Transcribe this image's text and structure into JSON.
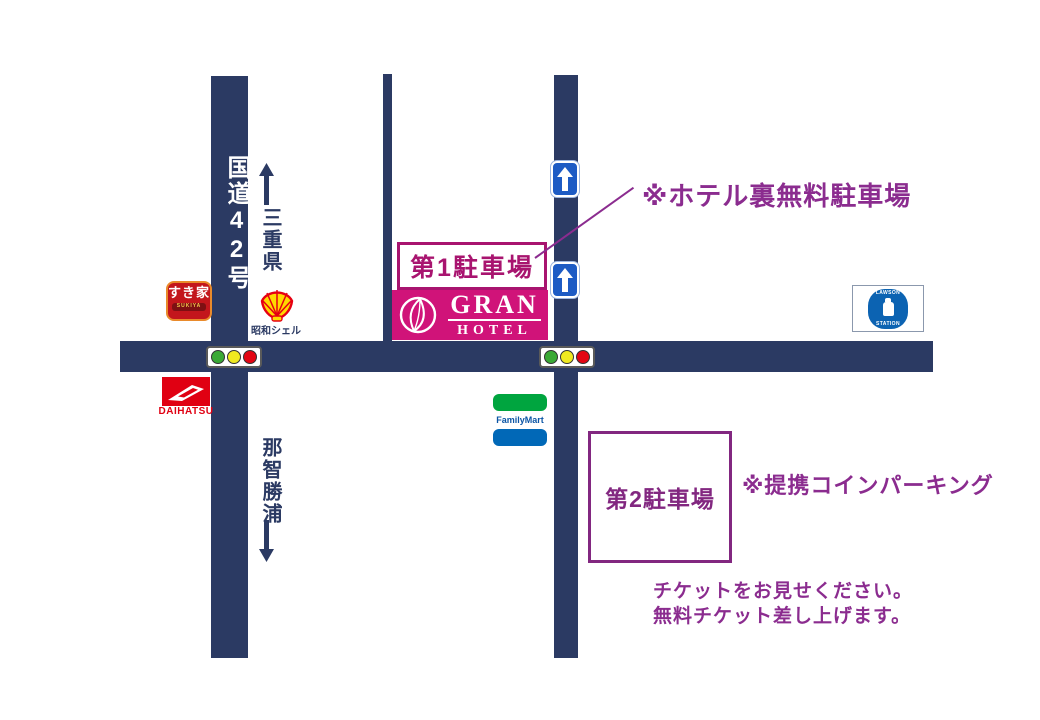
{
  "roads": {
    "route_label": "国道42号",
    "north_label": "三重県",
    "south_label": "那智勝浦"
  },
  "parking1": {
    "label": "第1駐車場",
    "note": "※ホテル裏無料駐車場"
  },
  "parking2": {
    "label": "第2駐車場",
    "note": "※提携コインパーキング",
    "ticket_line1": "チケットをお見せください。",
    "ticket_line2": "無料チケット差し上げます。"
  },
  "landmarks": {
    "sukiya": {
      "name": "すき家",
      "sub": "SUKIYA"
    },
    "shell": {
      "caption": "昭和シェル"
    },
    "daihatsu": {
      "caption": "DAIHATSU"
    },
    "gran_hotel": {
      "line1": "GRAN",
      "line2": "HOTEL"
    },
    "lawson": {
      "line1": "LAWSON",
      "line2": "STATION"
    },
    "familymart": {
      "name": "FamilyMart"
    }
  },
  "icons": {
    "north-arrow-icon": "navy up arrow",
    "south-arrow-icon": "navy down arrow",
    "one-way-up-sign-icon": "blue square sign with white up arrow (x2)",
    "traffic-light-icon": "green/yellow/red lamps (x2)",
    "shell-icon": "yellow pecten shell with red ribs",
    "daihatsu-d-icon": "white stylized D swoosh on red",
    "gran-leaf-icon": "white leaf in white circle outline",
    "milk-bottle-icon": "white milk bottle in Lawson emblem"
  },
  "colors": {
    "road_navy": "#2B3A63",
    "gran_magenta": "#D01379",
    "parking1_magenta": "#A8146F",
    "note_purple": "#8B2C8F",
    "sign_blue": "#1D5BC4",
    "traffic_green": "#3AA935",
    "traffic_yellow": "#F0E920",
    "traffic_red": "#E30613"
  }
}
